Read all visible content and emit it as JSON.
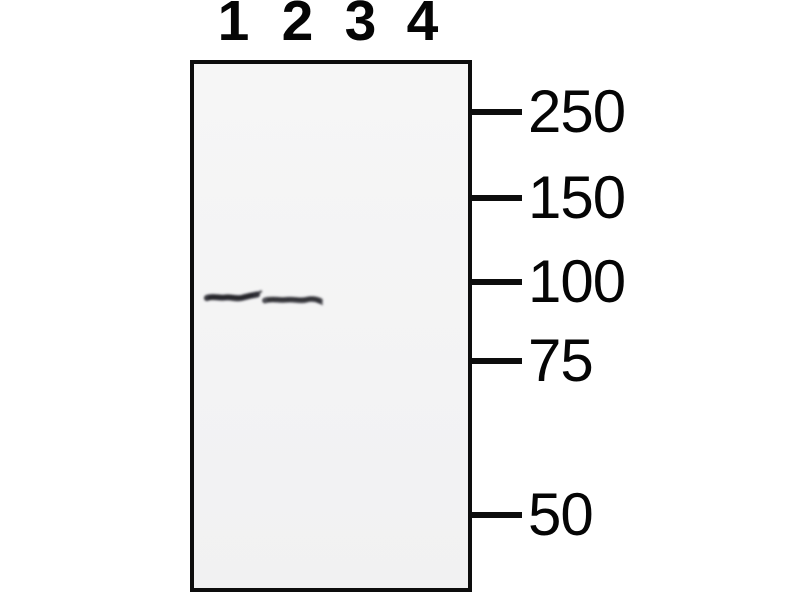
{
  "figure": {
    "type": "western-blot",
    "lane_labels": [
      "1",
      "2",
      "3",
      "4"
    ],
    "markers": [
      {
        "label": "250"
      },
      {
        "label": "150"
      },
      {
        "label": "100"
      },
      {
        "label": "75"
      },
      {
        "label": "50"
      }
    ],
    "bands": [
      {
        "lane": "1",
        "intensity": "strong",
        "position": "just below 100 marker"
      },
      {
        "lane": "2",
        "intensity": "strong",
        "position": "just below 100 marker"
      }
    ],
    "colors": {
      "page_background": "#ffffff",
      "blot_background": "#f4f4f4",
      "border": "#0d0d0d",
      "band": "#2e2e34",
      "text": "#050505"
    }
  }
}
